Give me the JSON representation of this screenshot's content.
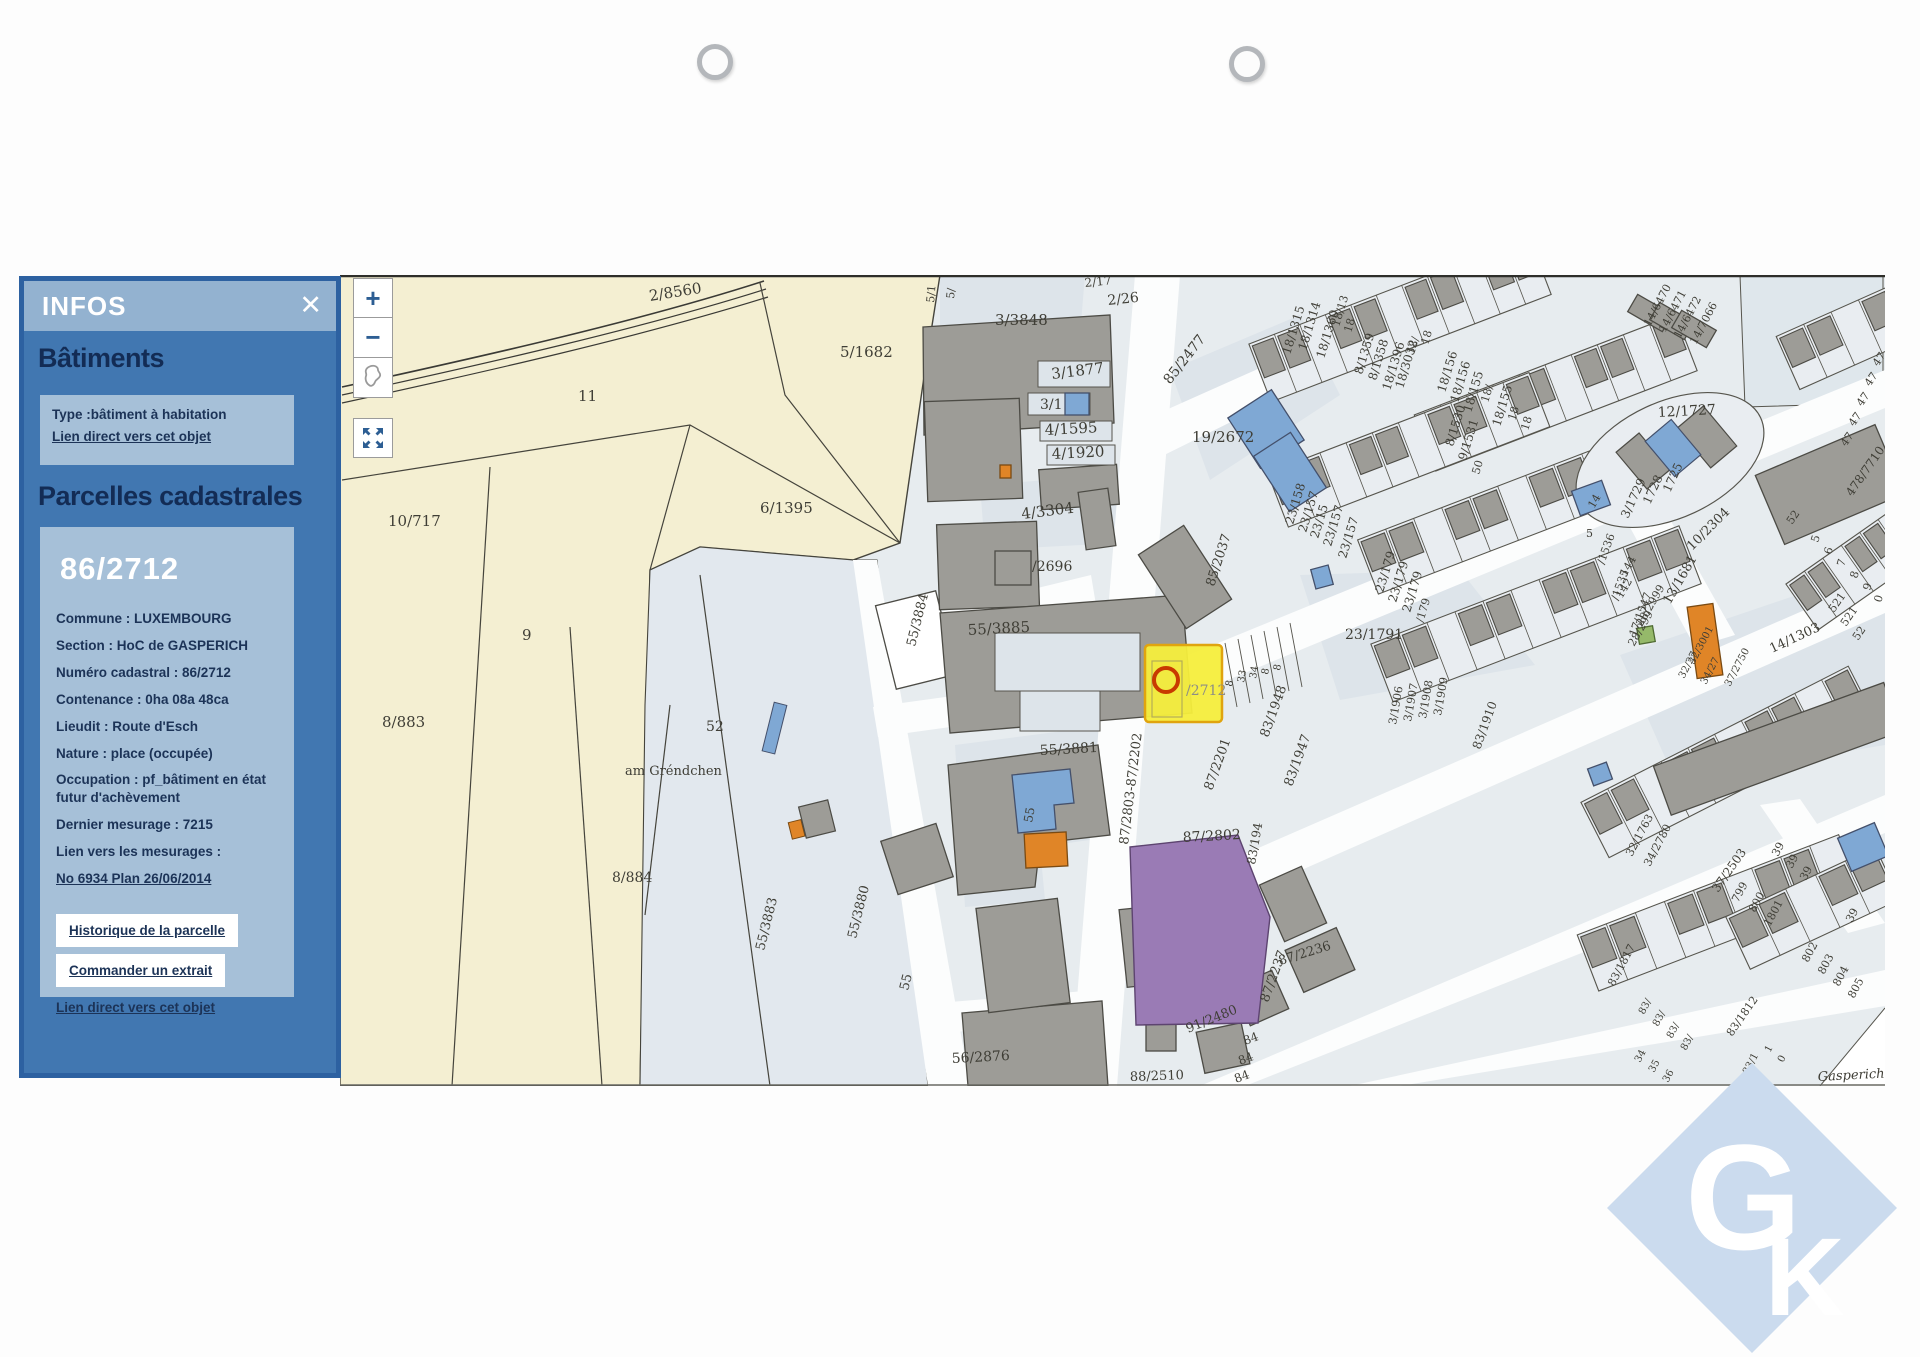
{
  "panel": {
    "title": "INFOS",
    "close_icon": "✕",
    "batiments": {
      "heading": "Bâtiments",
      "type_line": "Type :bâtiment à habitation",
      "link": "Lien direct vers cet objet"
    },
    "parcelles": {
      "heading": "Parcelles cadastrales",
      "parcel_id": "86/2712",
      "fields": [
        "Commune : LUXEMBOURG",
        "Section : HoC de GASPERICH",
        "Numéro cadastral : 86/2712",
        "Contenance : 0ha 08a 48ca",
        "Lieudit : Route d'Esch",
        "Nature : place (occupée)",
        "Occupation : pf_bâtiment en état futur d'achèvement",
        "Dernier mesurage : 7215",
        "Lien vers les mesurages :"
      ],
      "mesurage_link": "No 6934 Plan 26/06/2014",
      "history_button": "Historique de la parcelle",
      "order_button": "Commander un extrait",
      "direct_link": "Lien direct vers cet objet"
    }
  },
  "map_controls": {
    "zoom_in": "+",
    "zoom_out": "−"
  },
  "logo": {
    "g": "G",
    "k": "K"
  },
  "colors": {
    "panel_blue": "#4177b1",
    "panel_band": "#93b2d0",
    "panel_box": "#a6c0d8",
    "cream": "#f4efd2",
    "urban": "#e7ecef",
    "building": "#9d9c97",
    "selected_yellow": "#f6ee3c",
    "marker_red": "#c83a00",
    "purple": "#9a7bb5",
    "orange": "#e08527",
    "blue_bldg": "#7fa8d4",
    "logo_blue": "#cbdbee"
  },
  "map": {
    "selected_parcel_label": "/2712",
    "labels": [
      {
        "t": "2/8560",
        "x": 310,
        "y": 26,
        "r": -9,
        "s": 15
      },
      {
        "t": "5/1682",
        "x": 500,
        "y": 82,
        "s": 15
      },
      {
        "t": "11",
        "x": 238,
        "y": 126,
        "s": 15
      },
      {
        "t": "3/3848",
        "x": 655,
        "y": 50,
        "s": 15
      },
      {
        "t": "6/1395",
        "x": 420,
        "y": 238,
        "s": 15
      },
      {
        "t": "10/717",
        "x": 48,
        "y": 251,
        "s": 15
      },
      {
        "t": "9",
        "x": 182,
        "y": 365,
        "s": 15
      },
      {
        "t": "8/883",
        "x": 42,
        "y": 452,
        "s": 15
      },
      {
        "t": "52",
        "x": 366,
        "y": 456,
        "s": 14
      },
      {
        "t": "am Gréndchen",
        "x": 285,
        "y": 500,
        "s": 13
      },
      {
        "t": "8/884",
        "x": 272,
        "y": 607,
        "s": 14
      },
      {
        "t": "55/3883",
        "x": 424,
        "y": 676,
        "r": -76,
        "s": 13
      },
      {
        "t": "55/3880",
        "x": 516,
        "y": 664,
        "r": -76,
        "s": 13
      },
      {
        "t": "55/3884",
        "x": 575,
        "y": 372,
        "r": -76,
        "s": 13
      },
      {
        "t": "55",
        "x": 568,
        "y": 716,
        "r": -76,
        "s": 13
      },
      {
        "t": "56/2876",
        "x": 612,
        "y": 788,
        "r": -3,
        "s": 14
      },
      {
        "t": "5/1",
        "x": 594,
        "y": 28,
        "r": -85,
        "s": 11
      },
      {
        "t": "5/",
        "x": 614,
        "y": 24,
        "r": -85,
        "s": 11
      },
      {
        "t": "2/17",
        "x": 745,
        "y": 12,
        "r": -6,
        "s": 12
      },
      {
        "t": "2/26",
        "x": 768,
        "y": 30,
        "r": -6,
        "s": 14
      },
      {
        "t": "3/1877",
        "x": 712,
        "y": 104,
        "r": -7,
        "s": 15
      },
      {
        "t": "3/1",
        "x": 700,
        "y": 134,
        "s": 14
      },
      {
        "t": "4/1595",
        "x": 705,
        "y": 160,
        "r": -3,
        "s": 15
      },
      {
        "t": "4/1920",
        "x": 712,
        "y": 184,
        "r": -3,
        "s": 15
      },
      {
        "t": "4/3304",
        "x": 682,
        "y": 244,
        "r": -7,
        "s": 15
      },
      {
        "t": "/2696",
        "x": 692,
        "y": 296,
        "s": 14
      },
      {
        "t": "55/3885",
        "x": 628,
        "y": 360,
        "r": -3,
        "s": 15
      },
      {
        "t": "55/3881",
        "x": 700,
        "y": 480,
        "r": -3,
        "s": 14
      },
      {
        "t": "55",
        "x": 692,
        "y": 548,
        "r": -80,
        "s": 12
      },
      {
        "t": "19/2672",
        "x": 852,
        "y": 167,
        "s": 15
      },
      {
        "t": "85/2477",
        "x": 830,
        "y": 110,
        "r": -52,
        "s": 14
      },
      {
        "t": "85/2037",
        "x": 874,
        "y": 312,
        "r": -72,
        "s": 13
      },
      {
        "t": "87/2803-87/2202",
        "x": 788,
        "y": 570,
        "r": -83,
        "s": 13
      },
      {
        "t": "87/2201",
        "x": 872,
        "y": 516,
        "r": -70,
        "s": 13
      },
      {
        "t": "87/2802",
        "x": 843,
        "y": 567,
        "r": -3,
        "s": 14
      },
      {
        "t": "/2712",
        "x": 846,
        "y": 420,
        "s": 14,
        "c": "#8e8e85"
      },
      {
        "t": "23/1791",
        "x": 1005,
        "y": 364,
        "s": 14
      },
      {
        "t": "83/1948",
        "x": 928,
        "y": 463,
        "r": -70,
        "s": 13
      },
      {
        "t": "83/1947",
        "x": 952,
        "y": 512,
        "r": -70,
        "s": 13
      },
      {
        "t": "83/194",
        "x": 915,
        "y": 590,
        "r": -80,
        "s": 12
      },
      {
        "t": "87/2236",
        "x": 940,
        "y": 690,
        "r": -17,
        "s": 13
      },
      {
        "t": "87/2237",
        "x": 928,
        "y": 728,
        "r": -70,
        "s": 13
      },
      {
        "t": "91/2480",
        "x": 848,
        "y": 758,
        "r": -22,
        "s": 13
      },
      {
        "t": "84",
        "x": 905,
        "y": 770,
        "r": -20,
        "s": 12
      },
      {
        "t": "84",
        "x": 900,
        "y": 790,
        "r": -20,
        "s": 12
      },
      {
        "t": "84",
        "x": 896,
        "y": 808,
        "r": -20,
        "s": 12
      },
      {
        "t": "88/2510",
        "x": 790,
        "y": 806,
        "r": -2,
        "s": 13
      },
      {
        "t": "83/1910",
        "x": 1140,
        "y": 475,
        "r": -70,
        "s": 12
      },
      {
        "t": "3/1906",
        "x": 1056,
        "y": 450,
        "r": -80,
        "s": 11
      },
      {
        "t": "3/1907",
        "x": 1071,
        "y": 447,
        "r": -80,
        "s": 11
      },
      {
        "t": "3/1908",
        "x": 1086,
        "y": 444,
        "r": -80,
        "s": 11
      },
      {
        "t": "3/1909",
        "x": 1101,
        "y": 441,
        "r": -80,
        "s": 11
      },
      {
        "t": "8",
        "x": 892,
        "y": 412,
        "r": -80,
        "s": 10
      },
      {
        "t": "33",
        "x": 904,
        "y": 408,
        "r": -80,
        "s": 10
      },
      {
        "t": "34",
        "x": 916,
        "y": 404,
        "r": -80,
        "s": 10
      },
      {
        "t": "8",
        "x": 928,
        "y": 400,
        "r": -80,
        "s": 10
      },
      {
        "t": "8",
        "x": 940,
        "y": 396,
        "r": -80,
        "s": 10
      },
      {
        "t": "18/1315",
        "x": 950,
        "y": 80,
        "r": -73,
        "s": 12
      },
      {
        "t": "18/1314",
        "x": 966,
        "y": 76,
        "r": -73,
        "s": 12
      },
      {
        "t": "18/1360",
        "x": 984,
        "y": 84,
        "r": -73,
        "s": 12
      },
      {
        "t": "18/13",
        "x": 999,
        "y": 52,
        "r": -73,
        "s": 11
      },
      {
        "t": "18",
        "x": 1011,
        "y": 58,
        "r": -73,
        "s": 11
      },
      {
        "t": "8/1359",
        "x": 1022,
        "y": 100,
        "r": -73,
        "s": 12
      },
      {
        "t": "8/1358",
        "x": 1036,
        "y": 106,
        "r": -73,
        "s": 12
      },
      {
        "t": "18/1396",
        "x": 1050,
        "y": 116,
        "r": -73,
        "s": 12
      },
      {
        "t": "18/3032",
        "x": 1063,
        "y": 114,
        "r": -73,
        "s": 12
      },
      {
        "t": "18/",
        "x": 1074,
        "y": 80,
        "r": -73,
        "s": 11
      },
      {
        "t": "18",
        "x": 1088,
        "y": 70,
        "r": -73,
        "s": 11
      },
      {
        "t": "18/156",
        "x": 1105,
        "y": 118,
        "r": -73,
        "s": 12
      },
      {
        "t": "18/156",
        "x": 1118,
        "y": 128,
        "r": -73,
        "s": 12
      },
      {
        "t": "18/155",
        "x": 1131,
        "y": 138,
        "r": -73,
        "s": 12
      },
      {
        "t": "18/",
        "x": 1148,
        "y": 128,
        "r": -73,
        "s": 11
      },
      {
        "t": "8/1530",
        "x": 1113,
        "y": 172,
        "r": -73,
        "s": 12
      },
      {
        "t": "9/1531",
        "x": 1126,
        "y": 186,
        "r": -73,
        "s": 12
      },
      {
        "t": "50",
        "x": 1139,
        "y": 200,
        "r": -73,
        "s": 11
      },
      {
        "t": "18/155",
        "x": 1160,
        "y": 152,
        "r": -73,
        "s": 12
      },
      {
        "t": "18",
        "x": 1175,
        "y": 146,
        "r": -73,
        "s": 11
      },
      {
        "t": "18",
        "x": 1188,
        "y": 156,
        "r": -73,
        "s": 11
      },
      {
        "t": "23/158",
        "x": 953,
        "y": 250,
        "r": -73,
        "s": 12
      },
      {
        "t": "23/157",
        "x": 966,
        "y": 258,
        "r": -73,
        "s": 12
      },
      {
        "t": "23/15",
        "x": 978,
        "y": 264,
        "r": -73,
        "s": 12
      },
      {
        "t": "23/157",
        "x": 991,
        "y": 272,
        "r": -73,
        "s": 12
      },
      {
        "t": "23/157",
        "x": 1006,
        "y": 284,
        "r": -73,
        "s": 12
      },
      {
        "t": "23/179",
        "x": 1043,
        "y": 318,
        "r": -73,
        "s": 12
      },
      {
        "t": "23/179",
        "x": 1056,
        "y": 328,
        "r": -73,
        "s": 12
      },
      {
        "t": "23/179",
        "x": 1070,
        "y": 338,
        "r": -73,
        "s": 12
      },
      {
        "t": "/179",
        "x": 1083,
        "y": 348,
        "r": -73,
        "s": 11
      },
      {
        "t": "12/1727",
        "x": 1318,
        "y": 142,
        "r": -3,
        "s": 14
      },
      {
        "t": "14/6470",
        "x": 1310,
        "y": 52,
        "r": -62,
        "s": 11
      },
      {
        "t": "14/6471",
        "x": 1325,
        "y": 58,
        "r": -62,
        "s": 11
      },
      {
        "t": "14/6472",
        "x": 1340,
        "y": 64,
        "r": -62,
        "s": 11
      },
      {
        "t": "14/7066",
        "x": 1356,
        "y": 70,
        "r": -62,
        "s": 11
      },
      {
        "t": "47",
        "x": 1506,
        "y": 172,
        "r": -55,
        "s": 11
      },
      {
        "t": "47",
        "x": 1514,
        "y": 152,
        "r": -55,
        "s": 11
      },
      {
        "t": "47",
        "x": 1522,
        "y": 132,
        "r": -55,
        "s": 11
      },
      {
        "t": "47",
        "x": 1530,
        "y": 112,
        "r": -55,
        "s": 11
      },
      {
        "t": "47",
        "x": 1538,
        "y": 92,
        "r": -55,
        "s": 11
      },
      {
        "t": "478/7710",
        "x": 1512,
        "y": 222,
        "r": -55,
        "s": 12
      },
      {
        "t": "1725",
        "x": 1330,
        "y": 218,
        "r": -65,
        "s": 12
      },
      {
        "t": "1728",
        "x": 1310,
        "y": 230,
        "r": -65,
        "s": 12
      },
      {
        "t": "3/1729",
        "x": 1288,
        "y": 244,
        "r": -65,
        "s": 12
      },
      {
        "t": "14",
        "x": 1254,
        "y": 234,
        "r": -60,
        "s": 11
      },
      {
        "t": "5",
        "x": 1246,
        "y": 262,
        "s": 11
      },
      {
        "t": "/1536",
        "x": 1264,
        "y": 290,
        "r": -70,
        "s": 11
      },
      {
        "t": "/1535",
        "x": 1278,
        "y": 326,
        "r": -70,
        "s": 11
      },
      {
        "t": "17/1547",
        "x": 1296,
        "y": 362,
        "r": -70,
        "s": 11
      },
      {
        "t": "13/1681",
        "x": 1330,
        "y": 330,
        "r": -60,
        "s": 13
      },
      {
        "t": "10/2304",
        "x": 1352,
        "y": 276,
        "r": -45,
        "s": 13
      },
      {
        "t": "14/1303",
        "x": 1432,
        "y": 378,
        "r": -25,
        "s": 13
      },
      {
        "t": "144",
        "x": 1286,
        "y": 302,
        "r": -60,
        "s": 11
      },
      {
        "t": "142",
        "x": 1282,
        "y": 324,
        "r": -60,
        "s": 11
      },
      {
        "t": "28/2999",
        "x": 1302,
        "y": 352,
        "r": -60,
        "s": 11
      },
      {
        "t": "28/299",
        "x": 1294,
        "y": 372,
        "r": -60,
        "s": 11
      },
      {
        "t": "32/3001",
        "x": 1354,
        "y": 390,
        "r": -62,
        "s": 10
      },
      {
        "t": "32/27",
        "x": 1344,
        "y": 404,
        "r": -62,
        "s": 10
      },
      {
        "t": "34/27",
        "x": 1366,
        "y": 410,
        "r": -62,
        "s": 10
      },
      {
        "t": "37/2750",
        "x": 1390,
        "y": 412,
        "r": -62,
        "s": 10
      },
      {
        "t": "52",
        "x": 1452,
        "y": 250,
        "r": -55,
        "s": 11
      },
      {
        "t": "521",
        "x": 1494,
        "y": 338,
        "r": -55,
        "s": 11
      },
      {
        "t": "521",
        "x": 1506,
        "y": 352,
        "r": -55,
        "s": 11
      },
      {
        "t": "52",
        "x": 1518,
        "y": 366,
        "r": -55,
        "s": 11
      },
      {
        "t": "5",
        "x": 1478,
        "y": 268,
        "r": -73,
        "s": 11
      },
      {
        "t": "6",
        "x": 1491,
        "y": 280,
        "r": -73,
        "s": 11
      },
      {
        "t": "7",
        "x": 1504,
        "y": 292,
        "r": -73,
        "s": 11
      },
      {
        "t": "8",
        "x": 1517,
        "y": 304,
        "r": -73,
        "s": 11
      },
      {
        "t": "9",
        "x": 1530,
        "y": 316,
        "r": -73,
        "s": 11
      },
      {
        "t": "0",
        "x": 1541,
        "y": 328,
        "r": -73,
        "s": 11
      },
      {
        "t": "32/1763",
        "x": 1292,
        "y": 582,
        "r": -62,
        "s": 11
      },
      {
        "t": "34/2780",
        "x": 1310,
        "y": 592,
        "r": -62,
        "s": 11
      },
      {
        "t": "37/2503",
        "x": 1378,
        "y": 618,
        "r": -55,
        "s": 12
      },
      {
        "t": "799",
        "x": 1398,
        "y": 628,
        "r": -62,
        "s": 11
      },
      {
        "t": "800",
        "x": 1415,
        "y": 638,
        "r": -62,
        "s": 11
      },
      {
        "t": "1801",
        "x": 1430,
        "y": 652,
        "r": -62,
        "s": 11
      },
      {
        "t": "39",
        "x": 1438,
        "y": 582,
        "r": -62,
        "s": 11
      },
      {
        "t": "39",
        "x": 1452,
        "y": 594,
        "r": -62,
        "s": 11
      },
      {
        "t": "39",
        "x": 1466,
        "y": 606,
        "r": -62,
        "s": 11
      },
      {
        "t": "39",
        "x": 1512,
        "y": 648,
        "r": -62,
        "s": 11
      },
      {
        "t": "802",
        "x": 1468,
        "y": 688,
        "r": -62,
        "s": 11
      },
      {
        "t": "803",
        "x": 1484,
        "y": 700,
        "r": -62,
        "s": 11
      },
      {
        "t": "804",
        "x": 1499,
        "y": 712,
        "r": -62,
        "s": 11
      },
      {
        "t": "805",
        "x": 1514,
        "y": 724,
        "r": -62,
        "s": 11
      },
      {
        "t": "83/1817",
        "x": 1274,
        "y": 712,
        "r": -62,
        "s": 11
      },
      {
        "t": "83/",
        "x": 1304,
        "y": 740,
        "r": -62,
        "s": 10
      },
      {
        "t": "83/",
        "x": 1318,
        "y": 752,
        "r": -62,
        "s": 10
      },
      {
        "t": "83/",
        "x": 1332,
        "y": 764,
        "r": -62,
        "s": 10
      },
      {
        "t": "83/",
        "x": 1346,
        "y": 776,
        "r": -62,
        "s": 10
      },
      {
        "t": "34",
        "x": 1300,
        "y": 788,
        "r": -62,
        "s": 10
      },
      {
        "t": "35",
        "x": 1314,
        "y": 798,
        "r": -62,
        "s": 10
      },
      {
        "t": "36",
        "x": 1328,
        "y": 808,
        "r": -62,
        "s": 10
      },
      {
        "t": "83/1812",
        "x": 1392,
        "y": 762,
        "r": -55,
        "s": 11
      },
      {
        "t": "83/1",
        "x": 1408,
        "y": 800,
        "r": -62,
        "s": 10
      },
      {
        "t": "1",
        "x": 1430,
        "y": 778,
        "r": -62,
        "s": 10
      },
      {
        "t": "0",
        "x": 1443,
        "y": 788,
        "r": -62,
        "s": 10
      },
      {
        "t": "Gasperich",
        "x": 1478,
        "y": 806,
        "r": -3,
        "s": 13,
        "i": 1
      }
    ]
  }
}
